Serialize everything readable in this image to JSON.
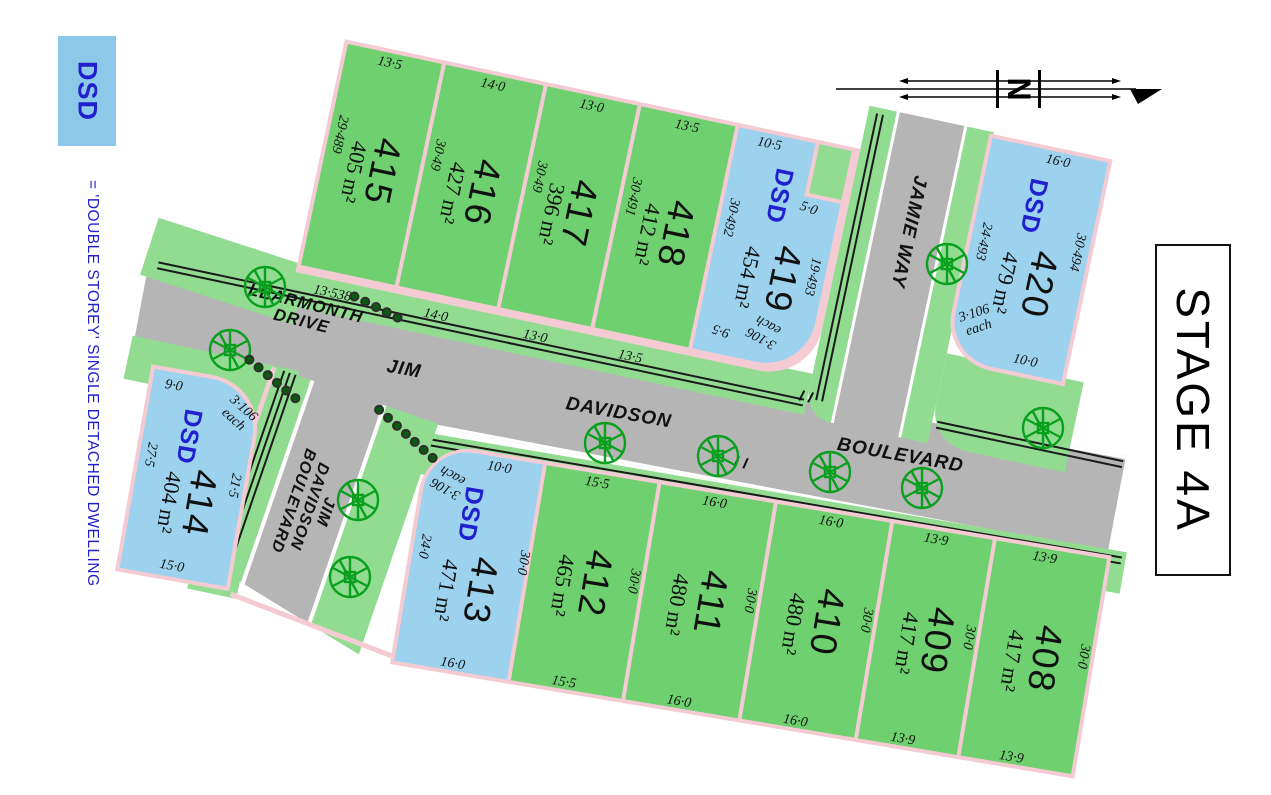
{
  "legend": {
    "abbr": "DSD",
    "definition": "=  'DOUBLE STOREY' SINGLE DETACHED DWELLING"
  },
  "title": "STAGE 4A",
  "north": {
    "label": "N"
  },
  "streets": {
    "learmonth": "LEARMONTH\nDRIVE",
    "jim": "JIM",
    "davidson": "DAVIDSON",
    "boulevard": "BOULEVARD",
    "jim_davidson_leg": "JIM DAVIDSON\nBOULEVARD",
    "jamie": "JAMIE WAY"
  },
  "dsd_label": "DSD",
  "lots": [
    {
      "number": "415",
      "area": "405 m²",
      "type": "standard",
      "dims": {
        "top": "13·5",
        "bottom": "13·538",
        "left": "29·489"
      }
    },
    {
      "number": "416",
      "area": "427 m²",
      "type": "standard",
      "dims": {
        "top": "14·0",
        "bottom": "14·0",
        "side": "30·49"
      }
    },
    {
      "number": "417",
      "area": "396 m²",
      "type": "standard",
      "dims": {
        "top": "13·0",
        "bottom": "13·0",
        "side": "30·49"
      }
    },
    {
      "number": "418",
      "area": "412 m²",
      "type": "standard",
      "dims": {
        "top": "13·5",
        "bottom": "13·5",
        "side": "30·491"
      }
    },
    {
      "number": "419",
      "area": "454 m²",
      "type": "dsd",
      "dims": {
        "top": "10·5",
        "side": "30·492",
        "notch": "5·0",
        "right": "19·493",
        "bottom": "9·5",
        "each": "3·106\neach"
      }
    },
    {
      "number": "420",
      "area": "479 m²",
      "type": "dsd",
      "dims": {
        "top": "16·0",
        "left": "24·493",
        "right": "30·494",
        "bottom": "10·0",
        "each": "3·106\neach"
      }
    },
    {
      "number": "414",
      "area": "404 m²",
      "type": "dsd",
      "dims": {
        "top": "9·0",
        "left": "27·5",
        "right": "21·5",
        "bottom": "15·0",
        "each": "3·106\neach"
      }
    },
    {
      "number": "413",
      "area": "471 m²",
      "type": "dsd",
      "dims": {
        "top": "10·0",
        "left": "24·0",
        "right": "30·0",
        "bottom": "16·0",
        "each": "3·106\neach"
      }
    },
    {
      "number": "412",
      "area": "465 m²",
      "type": "standard",
      "dims": {
        "top": "15·5",
        "bottom": "15·5",
        "right": "30·0"
      }
    },
    {
      "number": "411",
      "area": "480 m²",
      "type": "standard",
      "dims": {
        "top": "16·0",
        "bottom": "16·0",
        "right": "30·0"
      }
    },
    {
      "number": "410",
      "area": "480 m²",
      "type": "standard",
      "dims": {
        "top": "16·0",
        "bottom": "16·0",
        "right": "30·0"
      }
    },
    {
      "number": "409",
      "area": "417 m²",
      "type": "standard",
      "dims": {
        "top": "13·9",
        "bottom": "13·9",
        "right": "30·0"
      }
    },
    {
      "number": "408",
      "area": "417 m²",
      "type": "standard",
      "dims": {
        "top": "13·9",
        "bottom": "13·9",
        "right": "30·0"
      }
    }
  ],
  "colors": {
    "lot_green": "#6ED06E",
    "verge_green": "#92DC92",
    "dsd_blue": "#9DD2EE",
    "road_gray": "#B5B5B5",
    "boundary_pink": "#F4CBD3",
    "dsd_text_blue": "#2020CF",
    "tree_green": "#09A01E"
  }
}
